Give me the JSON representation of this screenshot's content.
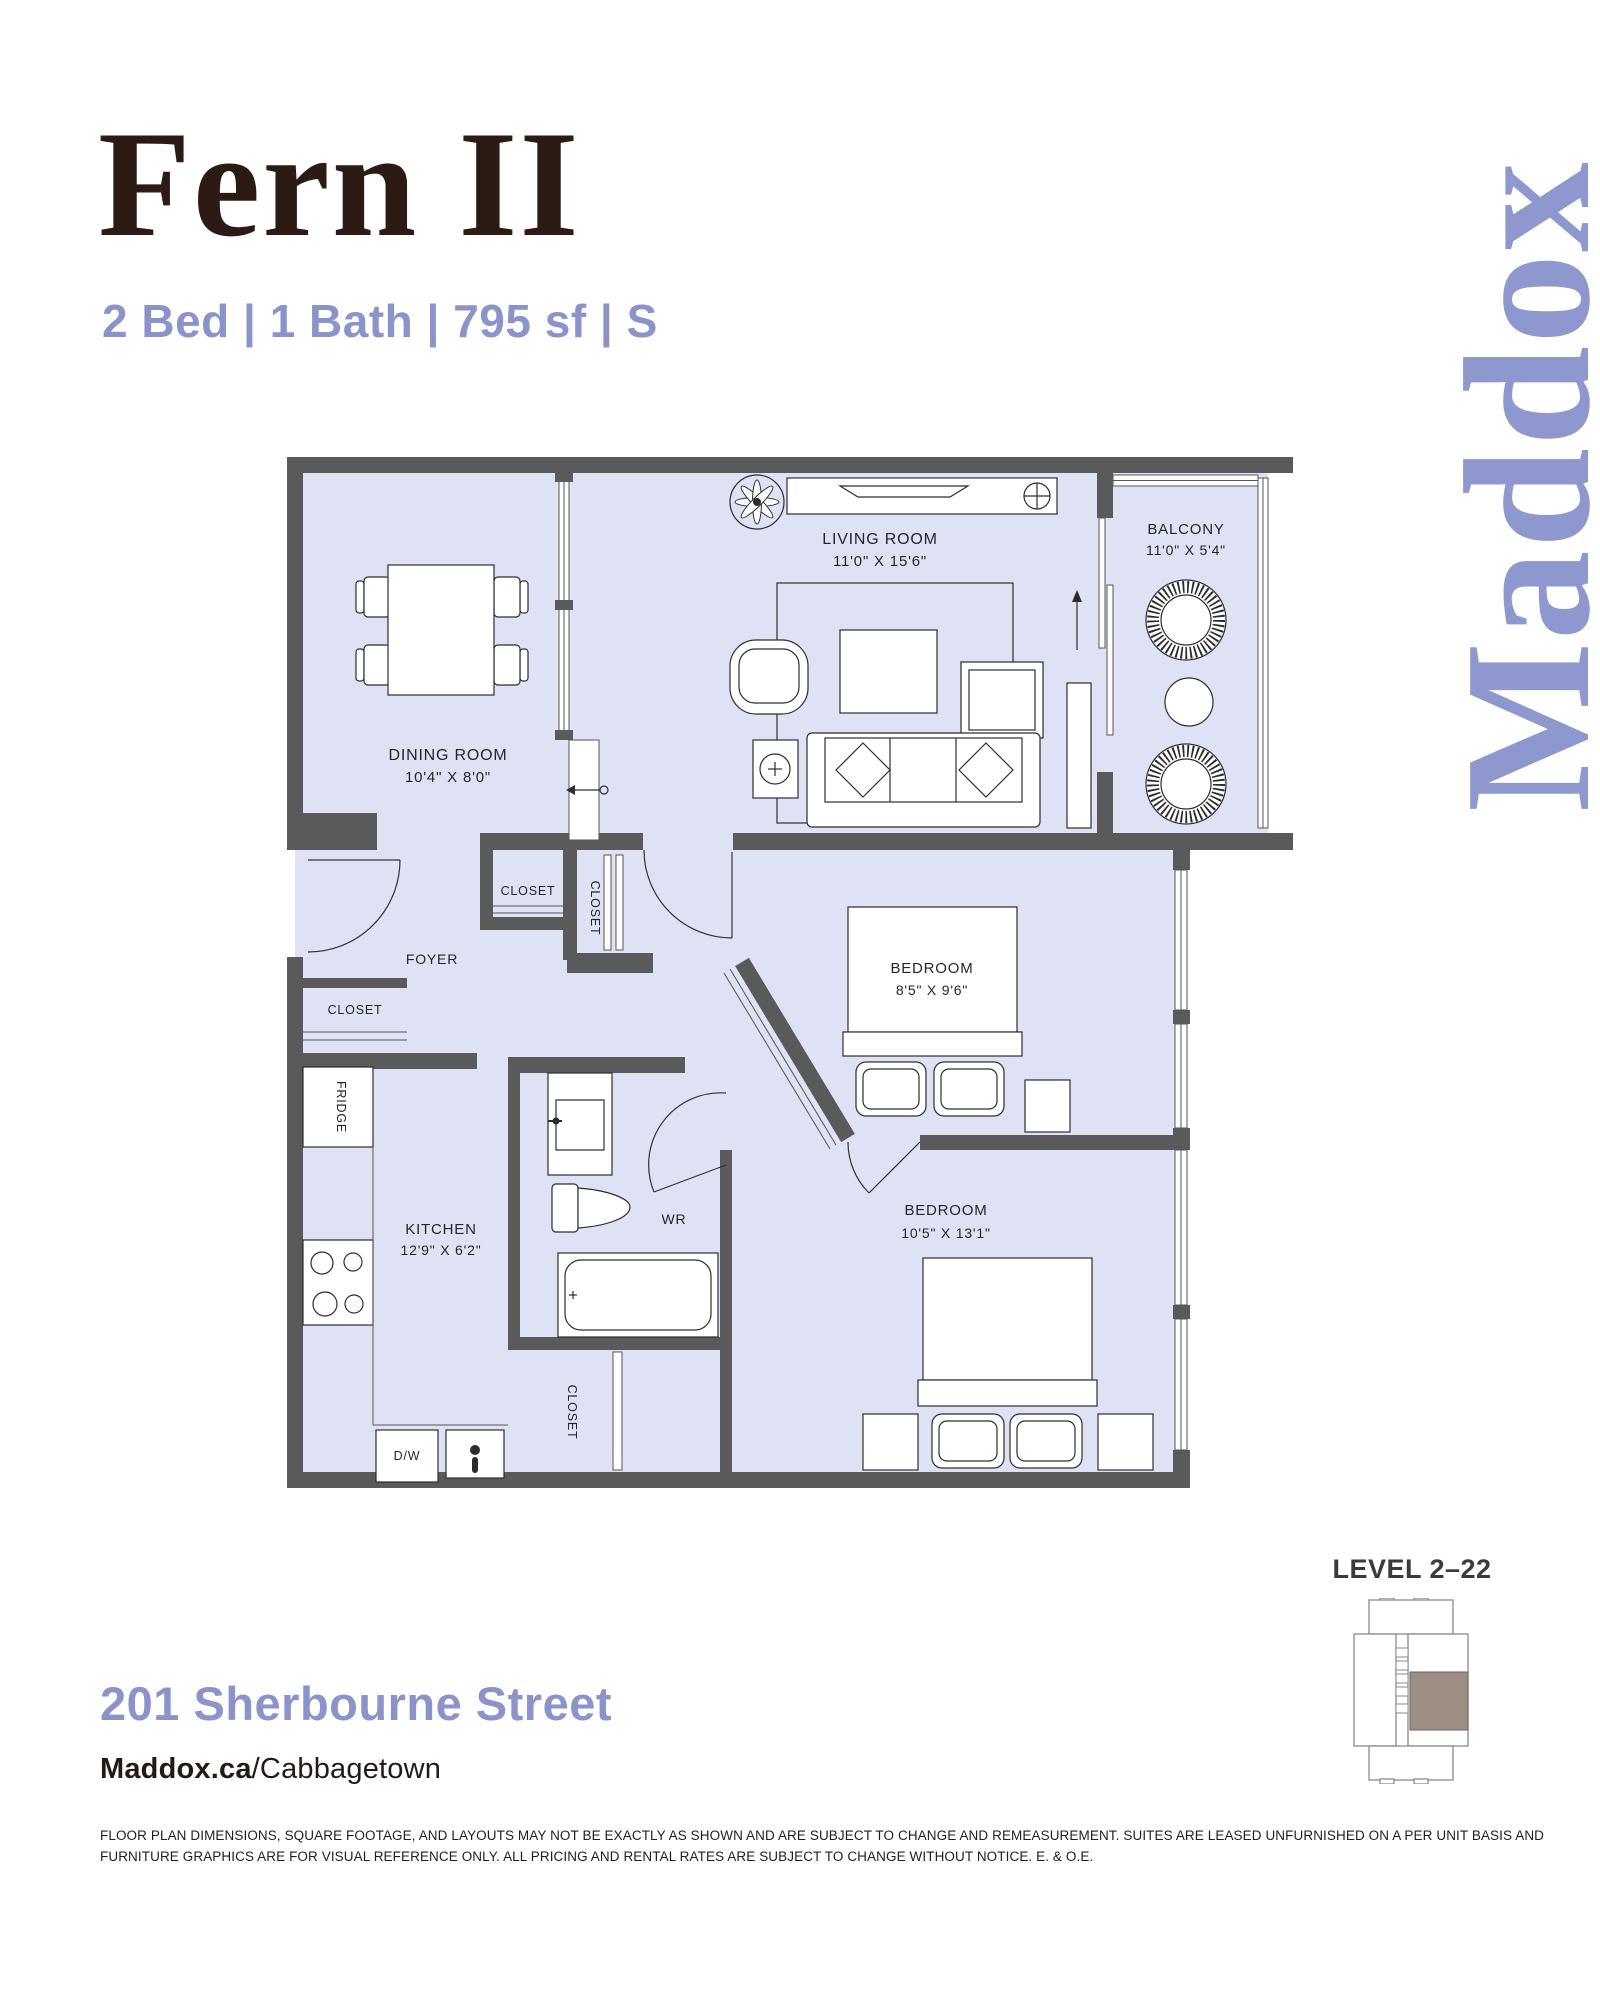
{
  "header": {
    "title": "Fern II",
    "specs": "2 Bed | 1 Bath | 795 sf | S",
    "brand_logo": "Maddox"
  },
  "floorplan": {
    "rooms": {
      "living": {
        "name": "LIVING ROOM",
        "dims": "11'0\" X 15'6\""
      },
      "balcony": {
        "name": "BALCONY",
        "dims": "11'0\" X 5'4\""
      },
      "dining": {
        "name": "DINING ROOM",
        "dims": "10'4\" X 8'0\""
      },
      "foyer": {
        "name": "FOYER"
      },
      "bedroom1": {
        "name": "BEDROOM",
        "dims": "8'5\" X 9'6\""
      },
      "kitchen": {
        "name": "KITCHEN",
        "dims": "12'9\" X 6'2\""
      },
      "wr": {
        "name": "WR"
      },
      "bedroom2": {
        "name": "BEDROOM",
        "dims": "10'5\" X 13'1\""
      }
    },
    "fixtures": {
      "closet": "CLOSET",
      "fridge": "FRIDGE",
      "dishwasher": "D/W"
    }
  },
  "keyplan": {
    "level_label": "LEVEL 2–22",
    "highlight_color": "#9d8e83"
  },
  "footer": {
    "address": "201 Sherbourne Street",
    "site": "Maddox.ca",
    "neighbourhood": "/Cabbagetown",
    "disclaimer_lines": [
      "FLOOR PLAN DIMENSIONS, SQUARE FOOTAGE, AND LAYOUTS MAY NOT BE EXACTLY AS SHOWN AND ARE SUBJECT TO CHANGE AND REMEASUREMENT. SUITES ARE LEASED UNFURNISHED ON A PER UNIT BASIS AND",
      "FURNITURE GRAPHICS ARE FOR VISUAL REFERENCE ONLY. ALL PRICING AND RENTAL RATES ARE SUBJECT TO CHANGE WITHOUT NOTICE. E. & O.E."
    ]
  },
  "colors": {
    "accent_periwinkle": "#8b94ca",
    "title_brown": "#2b1b14",
    "wall_gray": "#5a5a5a",
    "floor_lavender": "#dfe1f4"
  }
}
